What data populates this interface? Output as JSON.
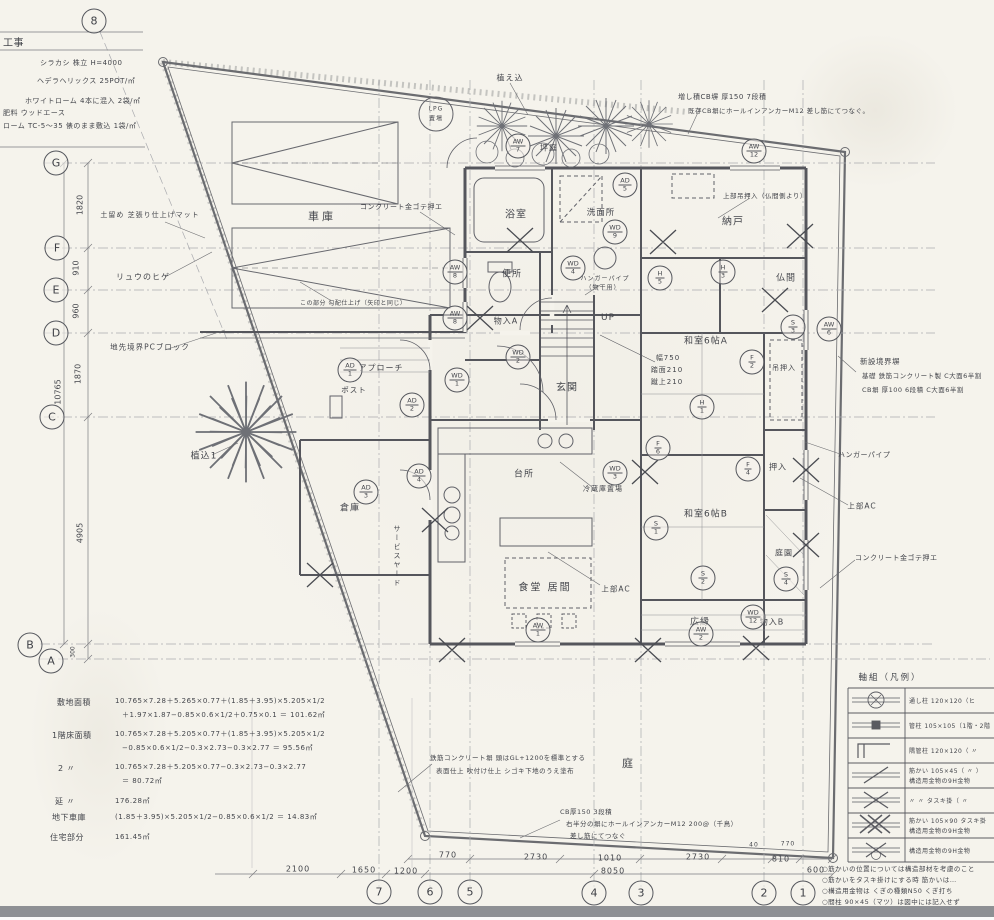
{
  "grid": {
    "left_labels": [
      "G",
      "F",
      "E",
      "D",
      "C",
      "B",
      "A"
    ],
    "bottom_labels": [
      "7",
      "6",
      "5",
      "4",
      "3",
      "2",
      "1"
    ],
    "top_label": "8"
  },
  "dims": {
    "left": {
      "d1": "1820",
      "d2": "910",
      "d3": "960",
      "d4": "1870",
      "overall": "10765",
      "d5": "4905",
      "d6": "300"
    },
    "bottom_upper": {
      "d1": "770",
      "d2": "2730",
      "d3": "1010",
      "d4": "2730",
      "d5": "810",
      "s1": "40",
      "s2": "770"
    },
    "bottom_lower": {
      "d1": "2100",
      "d2": "1650",
      "d3": "1200",
      "total": "8050",
      "d4": "600"
    }
  },
  "rooms": {
    "garage": "車庫",
    "bath": "浴室",
    "washroom": "洗面所",
    "toilet": "便所",
    "closet_a": "物入A",
    "entrance": "玄関",
    "nando": "納戸",
    "butsuma": "仏間",
    "washitsu_a": "和室6帖A",
    "washitsu_b": "和室6帖B",
    "kitchen": "台所",
    "dining": "食堂 居間",
    "hiroen": "広縁",
    "closet_b": "物入B",
    "oshiire": "押入",
    "tsuri_oshiire": "吊押入",
    "teien": "庭園",
    "souko": "倉庫",
    "tsuboniwa": "坪庭",
    "niwa": "庭",
    "lpg1": "LPG",
    "lpg2": "置場",
    "up": "UP",
    "approach": "アプローチ",
    "post": "ポスト",
    "service_yard": "サービスヤード"
  },
  "plants": {
    "uekomi": "植え込",
    "uekomi1": "植込1",
    "ryunohige": "リュウのヒゲ",
    "pc_block": "地先境界PCブロック",
    "dodome": "土留め 芝張り仕上げマット"
  },
  "notes": {
    "garage_finish": "コンクリート金ゴテ押エ",
    "garage_slope": "この部分 勾配仕上げ（矢印と同じ）",
    "right_finish": "コンクリート金ゴテ押エ",
    "hanger_right": "ハンガーパイプ",
    "hanger_stair1": "ハンガーパイプ",
    "hanger_stair2": "（物干用）",
    "ac1": "上部AC",
    "ac2": "上部AC",
    "refrigerator": "冷蔵庫置場",
    "tsuri_note": "上部吊押入（仏間側より）",
    "new_wall1": "新設境界塀",
    "new_wall2": "基礎 鉄筋コンクリート製 C大面6半割",
    "new_wall3": "CB塀 厚100 6段積 C大面6半割",
    "add_wall1": "増し積CB塀 厚150 7段積",
    "add_wall2": "既存CB塀にホールインアンカーM12 差し筋にてつなぐ。",
    "rc_wall1": "鉄筋コンクリート塀 頭はGL+1200を標準とする",
    "rc_wall2": "表面仕上 吹付け仕上 シゴキ下地のうえ塗布",
    "cb150_1": "CB厚150 3段積",
    "cb150_2": "右半分の塀にホールインアンカーM12 200@（千鳥）",
    "cb150_3": "差し筋にてつなぐ"
  },
  "stair": {
    "w": "幅750",
    "tread": "踏面210",
    "rise": "蹴上210"
  },
  "left_notes": {
    "title": "工事",
    "l1": "シラカシ 株立 H=4000",
    "l2": "ヘデラヘリックス 25POT/㎡",
    "l3": "ホワイトローム 4本に混入 2袋/㎡",
    "l4": "肥料 ウッドエース",
    "l5": "ローム TC-5〜35 俵のまま敷込 1袋/㎡"
  },
  "calc": {
    "rows": [
      {
        "label": "敷地面積",
        "l1": "10.765×7.28＋5.265×0.77＋(1.85＋3.95)×5.205×1/2",
        "l2": "＋1.97×1.87−0.85×0.6×1/2＋0.75×0.1 ＝ 101.62㎡"
      },
      {
        "label": "1階床面積",
        "l1": "10.765×7.28＋5.205×0.77＋(1.85＋3.95)×5.205×1/2",
        "l2": "−0.85×0.6×1/2−0.3×2.73−0.3×2.77 ＝ 95.56㎡"
      },
      {
        "label": "2 〃",
        "l1": "10.765×7.28＋5.205×0.77−0.3×2.73−0.3×2.77",
        "l2": "＝ 80.72㎡"
      },
      {
        "label": "延 〃",
        "l1": "176.28㎡",
        "l2": ""
      },
      {
        "label": "地下車庫",
        "l1": "(1.85＋3.95)×5.205×1/2−0.85×0.6×1/2 ＝ 14.83㎡",
        "l2": ""
      },
      {
        "label": "住宅部分",
        "l1": "161.45㎡",
        "l2": ""
      }
    ]
  },
  "legend": {
    "title": "軸組（凡例）",
    "rows": [
      {
        "d1": "通し柱 120×120（ヒ",
        "d2": ""
      },
      {
        "d1": "管柱 105×105（1階・2階",
        "d2": ""
      },
      {
        "d1": "隅管柱 120×120（ 〃",
        "d2": ""
      },
      {
        "d1": "筋かい 105×45（ 〃 ）",
        "d2": "構造用金物の9H金物"
      },
      {
        "d1": "〃 〃 タスキ掛（ 〃",
        "d2": ""
      },
      {
        "d1": "筋かい 105×90 タスキ掛",
        "d2": "構造用金物の9M金物"
      },
      {
        "d1": "構造用金物の9H金物",
        "d2": ""
      }
    ],
    "notes": [
      "○筋かいの位置については構造部材を考慮のこと",
      "○筋かいをタスキ掛けにする時 筋かいは…",
      "○構造用金物は くぎの種類N50 くぎ打ち",
      "○間柱 90×45（マツ）は図中には記入せず"
    ]
  },
  "symbols": [
    {
      "t": "AW",
      "b": "7"
    },
    {
      "t": "AW",
      "b": "12"
    },
    {
      "t": "AD",
      "b": "5"
    },
    {
      "t": "WD",
      "b": "9"
    },
    {
      "t": "AW",
      "b": "8"
    },
    {
      "t": "AW",
      "b": "8"
    },
    {
      "t": "WD",
      "b": "4"
    },
    {
      "t": "H",
      "b": "5"
    },
    {
      "t": "H",
      "b": "3"
    },
    {
      "t": "WD",
      "b": "2"
    },
    {
      "t": "WD",
      "b": "1"
    },
    {
      "t": "AD",
      "b": "1"
    },
    {
      "t": "AD",
      "b": "2"
    },
    {
      "t": "AD",
      "b": "4"
    },
    {
      "t": "AD",
      "b": "3"
    },
    {
      "t": "H",
      "b": "1"
    },
    {
      "t": "F",
      "b": "2"
    },
    {
      "t": "F",
      "b": "6"
    },
    {
      "t": "F",
      "b": "4"
    },
    {
      "t": "S",
      "b": "3"
    },
    {
      "t": "AW",
      "b": "6"
    },
    {
      "t": "S",
      "b": "1"
    },
    {
      "t": "S",
      "b": "2"
    },
    {
      "t": "S",
      "b": "4"
    },
    {
      "t": "WD",
      "b": "12"
    },
    {
      "t": "AW",
      "b": "2"
    },
    {
      "t": "AW",
      "b": "1"
    },
    {
      "t": "WD",
      "b": "3"
    }
  ]
}
